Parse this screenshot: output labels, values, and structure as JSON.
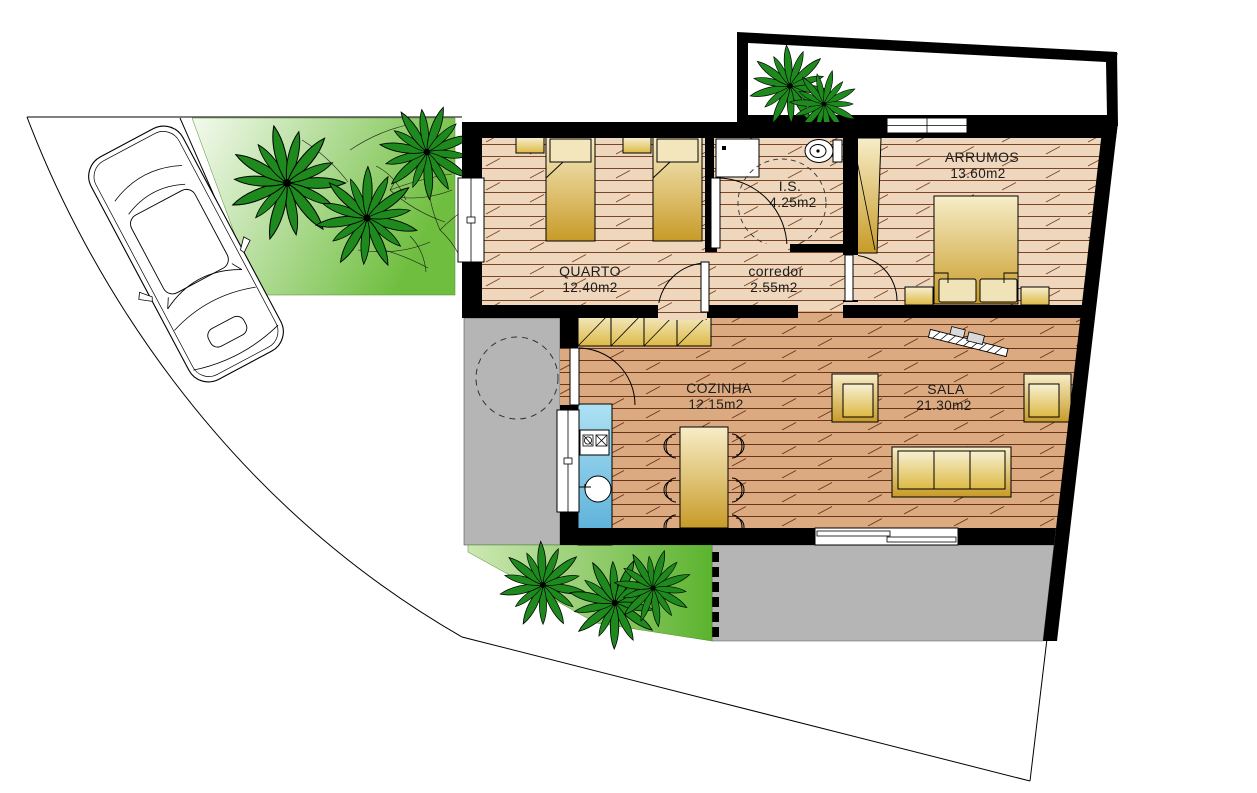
{
  "drawing": {
    "kind": "architectural floor plan",
    "units": "m2"
  },
  "rooms": [
    {
      "id": "quarto",
      "name": "QUARTO",
      "area": "12.40m2"
    },
    {
      "id": "is",
      "name": "I.S.",
      "area": "4.25m2"
    },
    {
      "id": "corredor",
      "name": "corredor",
      "area": "2.55m2"
    },
    {
      "id": "arrumos",
      "name": "ARRUMOS",
      "area": "13.60m2"
    },
    {
      "id": "cozinha",
      "name": "COZINHA",
      "area": "12.15m2"
    },
    {
      "id": "sala",
      "name": "SALA",
      "area": "21.30m2"
    }
  ],
  "colors": {
    "wall": "#000000",
    "floor_light": "#eed7bd",
    "floor_dark": "#dcaa80",
    "grass": "#6fbe3f",
    "paving_grey": "#b5b5b5",
    "counter_blue": "#7fc6e8",
    "furniture_gold": "#c89b28",
    "palm_green": "#1e8a1e"
  }
}
